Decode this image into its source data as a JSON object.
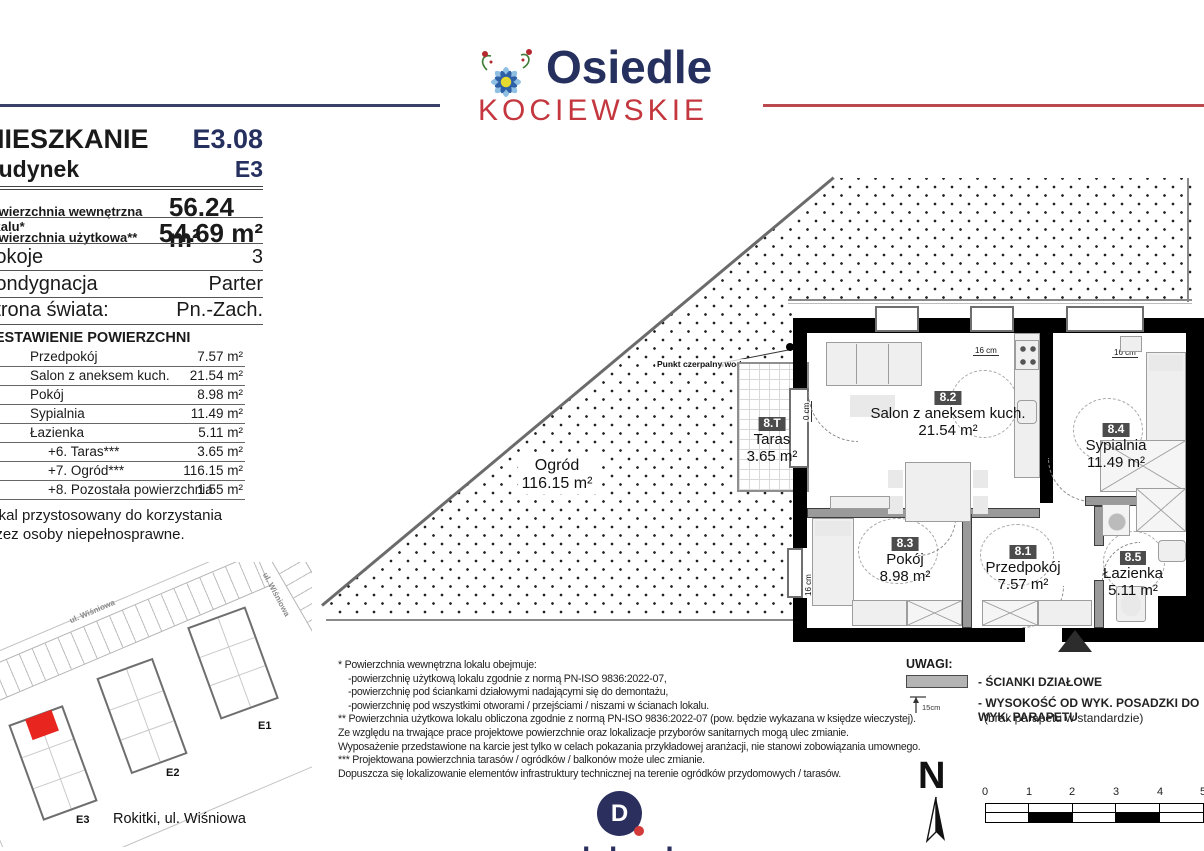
{
  "header": {
    "brand_line1": "Osiedle",
    "brand_line2": "KOCIEWSKIE",
    "colors": {
      "navy": "#26305f",
      "red": "#c4373f"
    }
  },
  "info": {
    "apartment_label": "MIESZKANIE",
    "apartment_value": "E3.08",
    "building_label": "Budynek",
    "building_value": "E3",
    "area_internal_label": "Powierzchnia wewnętrzna lokalu*",
    "area_internal_value": "56.24 m²",
    "area_usable_label": "Powierzchnia użytkowa**",
    "area_usable_value": "54.69 m²",
    "rooms_label": "Pokoje",
    "rooms_value": "3",
    "floor_label": "Kondygnacja",
    "floor_value": "Parter",
    "orientation_label": "Strona świata:",
    "orientation_value": "Pn.-Zach.",
    "table_title": "ZESTAWIENIE POWIERZCHNI",
    "rows": [
      {
        "no": "1",
        "name": "Przedpokój",
        "area": "7.57 m²"
      },
      {
        "no": "2",
        "name": "Salon z aneksem kuch.",
        "area": "21.54 m²"
      },
      {
        "no": "3",
        "name": "Pokój",
        "area": "8.98 m²"
      },
      {
        "no": "4",
        "name": "Sypialnia",
        "area": "11.49 m²"
      },
      {
        "no": "5",
        "name": "Łazienka",
        "area": "5.11 m²"
      },
      {
        "no": "",
        "name": "+6. Taras***",
        "area": "3.65 m²"
      },
      {
        "no": "",
        "name": "+7. Ogród***",
        "area": "116.15 m²"
      },
      {
        "no": "",
        "name": "+8. Pozostała powierzchnia",
        "area": "1.55 m²"
      }
    ],
    "accessibility_note": "Lokal przystosowany do korzystania przez osoby niepełnosprawne."
  },
  "plan": {
    "garden": {
      "name": "Ogród",
      "area": "116.15 m²"
    },
    "terrace": {
      "badge": "8.T",
      "name": "Taras",
      "area": "3.65 m²"
    },
    "rooms": [
      {
        "badge": "8.1",
        "name": "Przedpokój",
        "area": "7.57 m²"
      },
      {
        "badge": "8.2",
        "name": "Salon z aneksem kuch.",
        "area": "21.54 m²"
      },
      {
        "badge": "8.3",
        "name": "Pokój",
        "area": "8.98 m²"
      },
      {
        "badge": "8.4",
        "name": "Sypialnia",
        "area": "11.49 m²"
      },
      {
        "badge": "8.5",
        "name": "Łazienka",
        "area": "5.11 m²"
      }
    ],
    "water_point_label": "Punkt czerpalny wody",
    "window_dim_label": "16 cm",
    "door_dim_label": "0 cm"
  },
  "legend": {
    "title": "UWAGI:",
    "item1": "- ŚCIANKI DZIAŁOWE",
    "item2a": "- WYSOKOŚĆ OD WYK. POSADZKI DO WYK. PARAPETU",
    "item2b": "(brak parapetu w standardzie)",
    "height_label": "15cm"
  },
  "footnotes": {
    "lines": [
      {
        "t": "* Powierzchnia wewnętrzna lokalu obejmuje:"
      },
      {
        "t": "-powierzchnię użytkową lokalu zgodnie z normą PN-ISO 9836:2022-07,"
      },
      {
        "t": "-powierzchnię pod ściankami działowymi nadającymi się do demontażu,"
      },
      {
        "t": "-powierzchnię pod wszystkimi otworami / przejściami / niszami w ścianach lokalu."
      },
      {
        "t": "** Powierzchnia użytkowa lokalu obliczona zgodnie z normą PN-ISO 9836:2022-07 (pow. będzie wykazana w księdze wieczystej)."
      },
      {
        "t": "Ze względu na trwające prace projektowe powierzchnie oraz lokalizacje przyborów sanitarnych mogą ulec zmianie."
      },
      {
        "t": "Wyposażenie przedstawione na karcie jest tylko w celach pokazania przykładowej aranżacji, nie stanowi zobowiązania umownego."
      },
      {
        "t": "*** Projektowana powierzchnia tarasów / ogródków / balkonów może ulec zmianie."
      },
      {
        "t": "Dopuszcza się lokalizowanie elementów infrastruktury technicznej na terenie ogródków przydomowych / tarasów."
      }
    ]
  },
  "site": {
    "building_labels": [
      "E1",
      "E2",
      "E3"
    ],
    "street_label": "ul. Wiśniowa",
    "caption": "Rokitki, ul. Wiśniowa",
    "highlight_color": "#e8251f"
  },
  "compass": {
    "label": "N"
  },
  "scalebar": {
    "ticks": [
      "0",
      "1",
      "2",
      "3",
      "4",
      "5"
    ]
  },
  "footer_logo": {
    "initial": "D",
    "text": "dekpol"
  }
}
